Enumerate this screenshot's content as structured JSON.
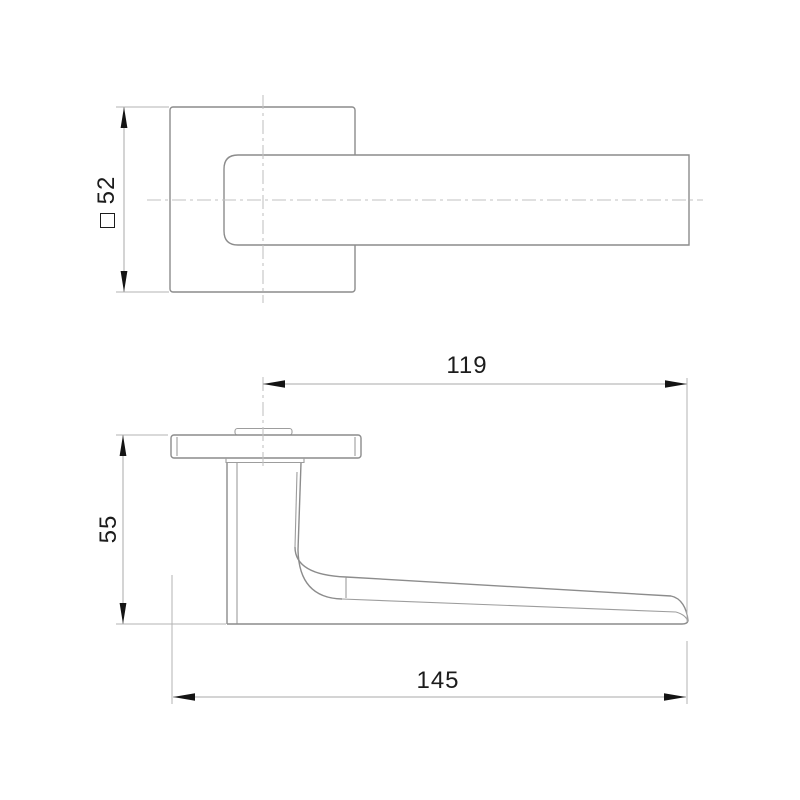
{
  "drawing": {
    "title": "Lever door handle on square rosette — two-view technical drawing",
    "views": [
      {
        "id": "front-view",
        "description": "front view: square rosette with straight lever bar"
      },
      {
        "id": "side-view",
        "description": "side profile: rosette edge, neck and tapered lever grip"
      }
    ],
    "dimensions": [
      {
        "id": "rosette-size",
        "value": "52",
        "symbol": "square-symbol",
        "orientation": "vertical"
      },
      {
        "id": "handle-height",
        "value": "55",
        "orientation": "vertical"
      },
      {
        "id": "lever-reach",
        "value": "119",
        "orientation": "horizontal"
      },
      {
        "id": "overall-length",
        "value": "145",
        "orientation": "horizontal"
      }
    ],
    "colors": {
      "part_line": "#8c8c8c",
      "thin_line": "#9d9d9d",
      "center_line": "#c2c2c2",
      "dimension_line": "#a9a9a9",
      "arrow": "#141414",
      "text": "#1c1c1c",
      "background": "#ffffff"
    }
  }
}
